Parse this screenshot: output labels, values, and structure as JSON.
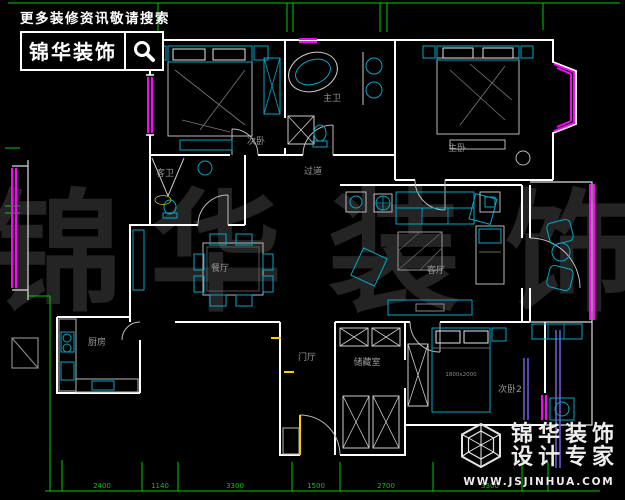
{
  "header": {
    "tagline": "更多装修资讯敬请搜索",
    "brand": "锦华装饰"
  },
  "watermark": {
    "chars": [
      "锦",
      "华",
      "装",
      "饰"
    ]
  },
  "floorplan": {
    "rooms": {
      "bedroom_top_left": "次卧",
      "master_bathroom": "主卫",
      "master_bedroom": "主卧",
      "guest_bathroom": "客卫",
      "hallway": "过道",
      "dining_room": "餐厅",
      "living_room": "客厅",
      "kitchen": "厨房",
      "entry_hall": "门厅",
      "storage_room": "储藏室",
      "bedroom_bottom_right": "次卧2"
    },
    "bed_size_label": "1800x2000",
    "dims_bottom": [
      "2400",
      "1140",
      "3300",
      "1500",
      "2700",
      "3300"
    ],
    "colors": {
      "background": "#000000",
      "walls": "#ffffff",
      "furniture_cyan": "#00a8cc",
      "fixtures_gray": "#b8b8b8",
      "windows_magenta": "#ff00ff",
      "dimensions_green": "#00cc00",
      "labels_gray": "#989898",
      "watermark_gray": "#242424",
      "door_yellow": "#ffcc00",
      "rail_purple": "#6a5acd"
    }
  },
  "footer": {
    "brand_line1": "锦华装饰",
    "brand_line2": "设计专家",
    "website": "WWW.JSJINHUA.COM"
  }
}
